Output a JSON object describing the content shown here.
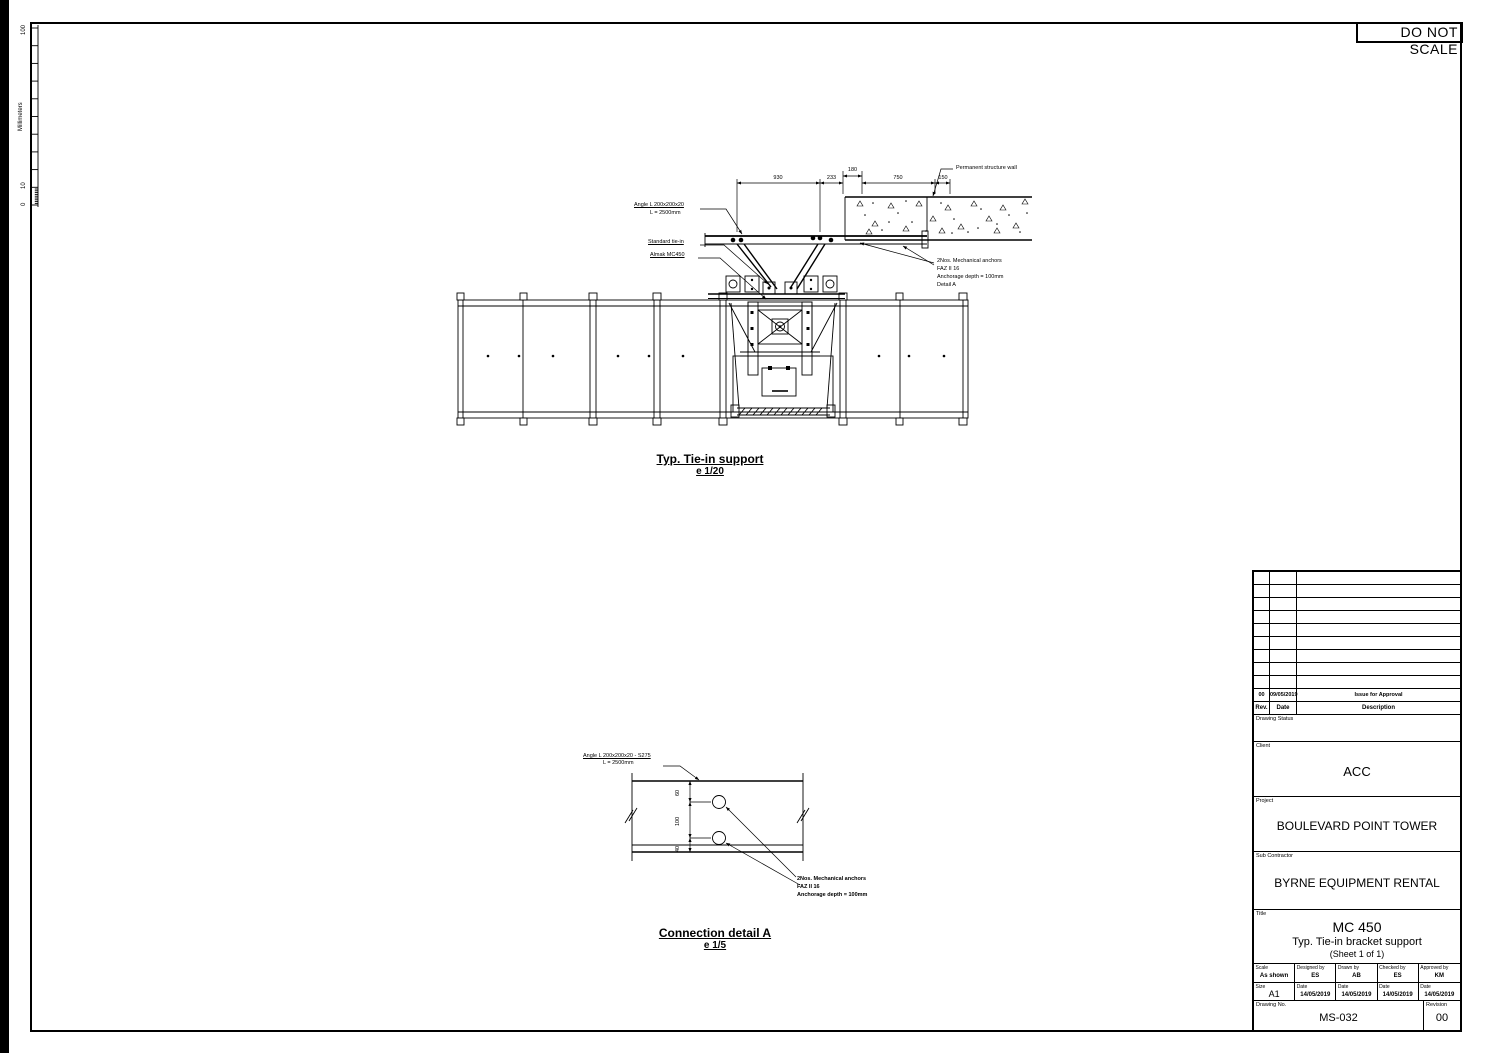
{
  "sheet": {
    "do_not_scale": "DO NOT SCALE"
  },
  "ruler": {
    "unit": "Millimeters",
    "t100": "100",
    "t10": "10",
    "t0": "0"
  },
  "top_drawing": {
    "title": "Typ. Tie-in support",
    "scale": "e 1/20",
    "labels": {
      "angle_line1": "Angle L 200x200x20",
      "angle_line2": "L = 2500mm",
      "standard_tiein": "Standard tie-in",
      "machine": "Almak MC450",
      "wall": "Permanent structure wall",
      "anchors_line1": "2Nos. Mechanical anchors",
      "anchors_line2": "FAZ II 16",
      "anchors_line3": "Anchorage depth = 100mm",
      "anchors_line4": "Detail A"
    },
    "dimensions": [
      "930",
      "233",
      "180",
      "750",
      "150"
    ]
  },
  "detail_drawing": {
    "title": "Connection detail A",
    "scale": "e 1/5",
    "labels": {
      "angle_line1": "Angle L 200x200x20 - S275",
      "angle_line2": "L = 2500mm",
      "anchors_line1": "2Nos. Mechanical anchors",
      "anchors_line2": "FAZ II 16",
      "anchors_line3": "Anchorage depth = 100mm"
    },
    "dimensions": [
      "60",
      "100",
      "40"
    ]
  },
  "title_block": {
    "revision_table": {
      "row": {
        "rev": "00",
        "date": "09/05/2019",
        "description": "Issue for Approval"
      },
      "header": {
        "rev": "Rev.",
        "date": "Date",
        "description": "Description"
      }
    },
    "drawing_status_label": "Drawing Status",
    "client_label": "Client",
    "client": "ACC",
    "project_label": "Project",
    "project": "BOULEVARD POINT TOWER",
    "sub_contractor_label": "Sub Contractor",
    "sub_contractor": "BYRNE EQUIPMENT RENTAL",
    "title_label": "Title",
    "title_line1": "MC 450",
    "title_line2": "Typ. Tie-in bracket support",
    "title_line3": "(Sheet 1 of 1)",
    "meta": {
      "scale_label": "Scale",
      "scale": "As shown",
      "designed_label": "Designed by",
      "designed": "ES",
      "drawn_label": "Drawn by",
      "drawn": "AB",
      "checked_label": "Checked by",
      "checked": "ES",
      "approved_label": "Approved by",
      "approved": "KM",
      "size_label": "Size",
      "size": "A1",
      "date_label": "Date",
      "date": "14/05/2019",
      "drawing_no_label": "Drawing No.",
      "drawing_no": "MS-032",
      "revision_label": "Revision",
      "revision": "00"
    }
  }
}
